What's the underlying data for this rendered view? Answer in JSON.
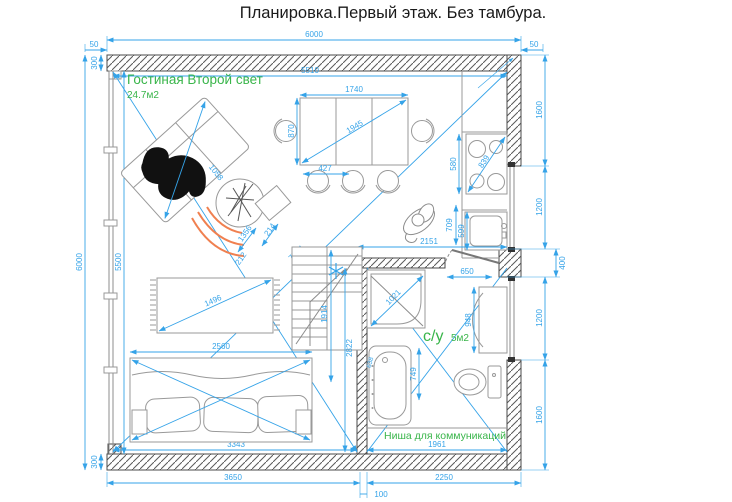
{
  "title": "Планировка.Первый этаж. Без тамбура.",
  "colors": {
    "dimension_blue": "#35a3e8",
    "label_green": "#39b54a",
    "wall_gray": "#4a4a4a",
    "furniture_gray": "#999999",
    "rug_orange": "#f08050",
    "silhouette_black": "#111111"
  },
  "rooms": {
    "living": {
      "name": "Гостиная Второй свет",
      "area": "24.7м2"
    },
    "bathroom": {
      "name": "с/у",
      "area": "5м2"
    },
    "niche": {
      "name": "Ниша для коммуникаций"
    }
  },
  "dims": {
    "top_left_50": "50",
    "top_width": "6000",
    "top_right_50": "50",
    "top_wall_300": "300",
    "top_inner": "5510",
    "left_height": "6000",
    "left_inner": "5500",
    "bottom_left_300": "300",
    "right_top": "1600",
    "right_window_top": "1200",
    "right_stub": "400",
    "right_window_bottom": "1200",
    "right_bottom": "1600",
    "bottom_inner_left": "3343",
    "bottom_inner_right": "1961",
    "bottom_left_run": "3650",
    "bottom_wall_gap": "100",
    "bottom_right_run": "2250",
    "table_width": "1740",
    "table_depth": "870",
    "table_diag": "1945",
    "chair_pitch": "427",
    "chaise_diag": "1058",
    "gap_1356": "1356",
    "gap_214": "214",
    "gap_212": "212",
    "rug_diag": "1496",
    "sofa_width": "2560",
    "room_diag": "7774",
    "stair_height": "2822",
    "stair_run": "1914",
    "stove_width": "580",
    "stove_diag": "839",
    "sink_depth": "599",
    "person_width": "709",
    "kitchen_run": "2151",
    "door_opening": "650",
    "shower_diag": "1021",
    "cabinet_height": "948",
    "tub_length": "749",
    "tub_width": "638"
  }
}
